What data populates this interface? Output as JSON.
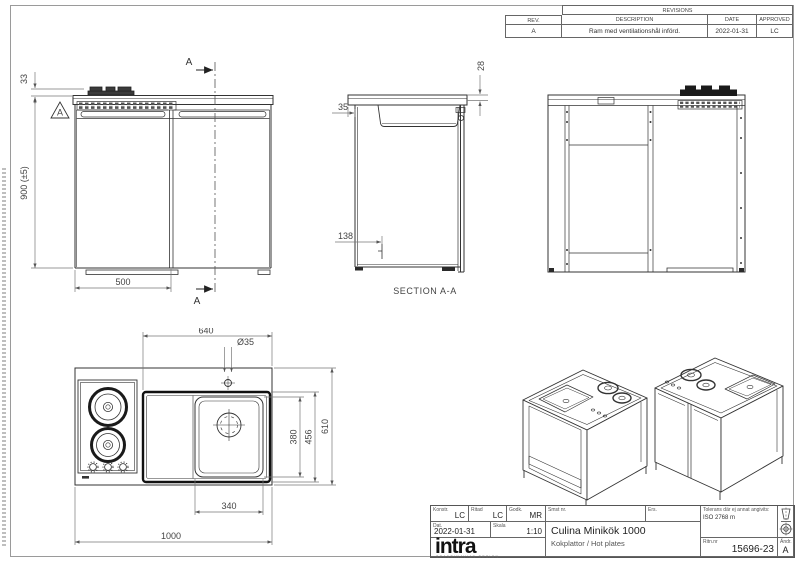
{
  "revisions": {
    "title": "REVISIONS",
    "headers": {
      "rev": "REV.",
      "description": "DESCRIPTION",
      "date": "DATE",
      "approved": "APPROVED"
    },
    "rows": [
      {
        "rev": "A",
        "description": "Ram med ventilationshål införd.",
        "date": "2022-01-31",
        "approved": "LC"
      }
    ]
  },
  "views": {
    "front": {
      "dim_hob_height": "33",
      "dim_total_height": "900 (±5)",
      "dim_left_width": "500",
      "section_arrow_top": "A",
      "section_arrow_bottom": "A",
      "revision_marker": "A"
    },
    "section": {
      "label": "SECTION A-A",
      "dim_edge": "28",
      "dim_overhang": "35",
      "dim_recess": "138"
    },
    "plan": {
      "dim_module_width": "640",
      "dim_hole_dia": "Ø35",
      "dim_bowl_width": "340",
      "dim_total_width": "1000",
      "dim_bowl_depth": "380",
      "dim_module_depth": "456",
      "dim_total_depth": "610"
    }
  },
  "title_block": {
    "konstr_label": "Konstr.",
    "konstr": "LC",
    "ritad_label": "Ritad",
    "ritad": "LC",
    "godk_label": "Godk.",
    "godk": "MR",
    "dat_label": "Dat.",
    "dat": "2022-01-31",
    "skala_label": "Skala",
    "skala": "1:10",
    "smst_label": "Smst nr.",
    "ers_label": "Ers.",
    "product_title": "Culina Minikök 1000",
    "product_subtitle": "Kokplattor / Hot plates",
    "tolerance_label": "Tolerans där ej annat angivits:",
    "tolerance_value": "ISO 2768 m",
    "drawing_no_label": "Ritn.nr",
    "drawing_no": "15696-23",
    "rev_label": "Ändr.",
    "rev": "A",
    "logo": "intra",
    "logo_sub": "SCANDINAVIAN DESIGN"
  },
  "colors": {
    "background": "#ffffff",
    "line": "#333333",
    "dim": "#555555",
    "dark": "#1a1a1a",
    "frame": "#9a9a9a"
  }
}
